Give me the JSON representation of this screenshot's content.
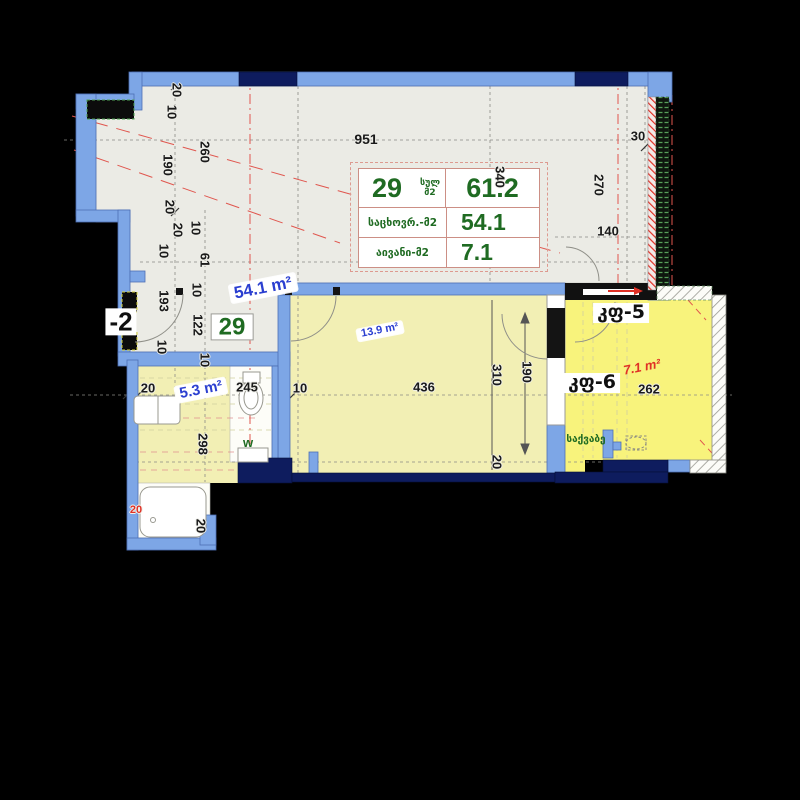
{
  "colors": {
    "wall_blue": "#7da6e6",
    "wall_navy": "#0e1c5e",
    "floor_gray": "#ebebe5",
    "floor_yellow": "#f2efb4",
    "floor_balcony": "#f8f37c",
    "accent_green": "#1f6b22",
    "accent_blue": "#2b3fd0",
    "accent_red": "#e03126"
  },
  "unit_table": {
    "unit_number": "29",
    "unit_total_label": "სულ მ2",
    "unit_total_value": "61.2",
    "rows": [
      {
        "label": "საცხოვრ.-მ2",
        "value": "54.1"
      },
      {
        "label": "აივანი-მ2",
        "value": "7.1"
      }
    ]
  },
  "room_labels": [
    {
      "id": "area-total",
      "text": "54.1 m²",
      "x": 263,
      "y": 288,
      "rot": -11,
      "cls": "rl-blue",
      "size": 17
    },
    {
      "id": "area-bath",
      "text": "5.3 m²",
      "x": 201,
      "y": 390,
      "rot": -11,
      "cls": "rl-blue",
      "size": 15
    },
    {
      "id": "area-bedroom",
      "text": "13.9 m²",
      "x": 380,
      "y": 331,
      "rot": -11,
      "cls": "rl-blue",
      "size": 11
    },
    {
      "id": "area-balcony",
      "text": "7.1 m²",
      "x": 642,
      "y": 367,
      "rot": -11,
      "cls": "rl-red",
      "size": 13
    },
    {
      "id": "unit-number-plan",
      "text": "29",
      "x": 232,
      "y": 327,
      "rot": 0,
      "cls": "rl-green-box",
      "size": 24
    },
    {
      "id": "stairwell",
      "text": "-2",
      "x": 121,
      "y": 322,
      "rot": 0,
      "cls": "rl-black-box",
      "size": 26
    },
    {
      "id": "wc-mark",
      "text": "w",
      "x": 248,
      "y": 443,
      "rot": 0,
      "cls": "rl-green",
      "size": 13
    },
    {
      "id": "block-5",
      "text": "კფ-5",
      "x": 621,
      "y": 313,
      "rot": 0,
      "cls": "rl-black-box geo",
      "size": 19
    },
    {
      "id": "block-6",
      "text": "კფ-6",
      "x": 592,
      "y": 383,
      "rot": 0,
      "cls": "rl-black-box geo",
      "size": 19
    },
    {
      "id": "boiler-room",
      "text": "საქვაბე",
      "x": 586,
      "y": 440,
      "rot": 0,
      "cls": "rl-green geo",
      "size": 10
    }
  ],
  "dimension_labels": [
    {
      "v": "20",
      "x": 177,
      "y": 90,
      "r": 90
    },
    {
      "v": "10",
      "x": 172,
      "y": 112,
      "r": 90
    },
    {
      "v": "260",
      "x": 205,
      "y": 152,
      "r": 90
    },
    {
      "v": "190",
      "x": 168,
      "y": 165,
      "r": 90
    },
    {
      "v": "20",
      "x": 170,
      "y": 207,
      "r": 90
    },
    {
      "v": "20",
      "x": 178,
      "y": 230,
      "r": 90
    },
    {
      "v": "10",
      "x": 196,
      "y": 228,
      "r": 90
    },
    {
      "v": "10",
      "x": 164,
      "y": 251,
      "r": 90
    },
    {
      "v": "61",
      "x": 205,
      "y": 260,
      "r": 90
    },
    {
      "v": "193",
      "x": 164,
      "y": 301,
      "r": 90
    },
    {
      "v": "10",
      "x": 197,
      "y": 290,
      "r": 90
    },
    {
      "v": "122",
      "x": 198,
      "y": 325,
      "r": 90
    },
    {
      "v": "10",
      "x": 162,
      "y": 347,
      "r": 90
    },
    {
      "v": "10",
      "x": 205,
      "y": 360,
      "r": 90
    },
    {
      "v": "20",
      "x": 148,
      "y": 388,
      "r": 0
    },
    {
      "v": "245",
      "x": 247,
      "y": 387,
      "r": 0
    },
    {
      "v": "10",
      "x": 300,
      "y": 388,
      "r": 0
    },
    {
      "v": "436",
      "x": 424,
      "y": 387,
      "r": 0
    },
    {
      "v": "298",
      "x": 203,
      "y": 444,
      "r": 90
    },
    {
      "v": "20",
      "x": 201,
      "y": 526,
      "r": 90
    },
    {
      "v": "20",
      "x": 136,
      "y": 510,
      "r": 0,
      "color": "#e03126",
      "size": 11
    },
    {
      "v": "951",
      "x": 366,
      "y": 139,
      "r": 0,
      "size": 14
    },
    {
      "v": "30",
      "x": 638,
      "y": 136,
      "r": 0
    },
    {
      "v": "270",
      "x": 599,
      "y": 185,
      "r": 90
    },
    {
      "v": "140",
      "x": 608,
      "y": 231,
      "r": 0
    },
    {
      "v": "340",
      "x": 500,
      "y": 177,
      "r": 90
    },
    {
      "v": "310",
      "x": 497,
      "y": 375,
      "r": 90
    },
    {
      "v": "190",
      "x": 527,
      "y": 372,
      "r": 90
    },
    {
      "v": "20",
      "x": 497,
      "y": 462,
      "r": 90
    },
    {
      "v": "262",
      "x": 649,
      "y": 389,
      "r": 0
    }
  ]
}
